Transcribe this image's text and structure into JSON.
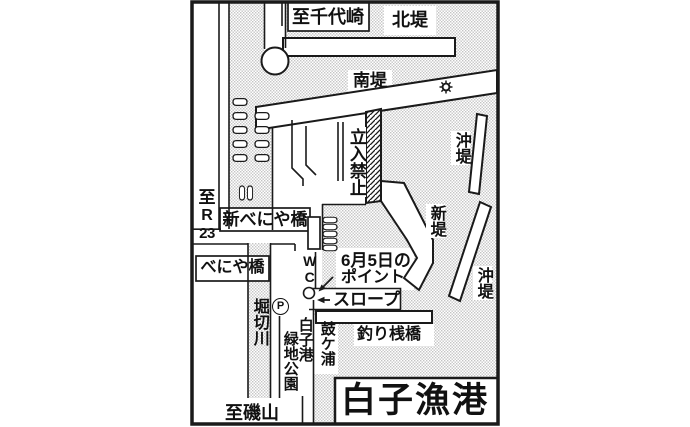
{
  "map": {
    "title": "白子漁港",
    "labels": {
      "to_chiyozaki": "至千代崎",
      "north_breakwater": "北堤",
      "south_breakwater": "南堤",
      "offshore_breakwater_upper": "沖堤",
      "offshore_breakwater_lower": "沖堤",
      "no_entry": "立入禁止",
      "new_breakwater": "新堤",
      "route_sign": {
        "chars": [
          "至",
          "R",
          "23"
        ]
      },
      "shin_beniya_bridge": "新べにや橋",
      "beniya_bridge": "べにや橋",
      "wc": "WC",
      "point_line1": "6月5日の",
      "point_line2": "ポイント",
      "slope": "スロープ",
      "parking": "P",
      "horikiri_river": "堀切川",
      "park_col_right": "白子港",
      "park_col_left": "緑地公園",
      "tsuzumigaura": "鼓ケ浦",
      "fishing_pier": "釣り桟橋",
      "to_isoyama": "至磯山"
    },
    "icons": {
      "harbor_light": "sun-gear-icon",
      "parking": "circled-p-icon",
      "point_marker": "small-circle-icon",
      "point_arrow": "arrow-down-left-icon",
      "slope_arrow": "arrow-left-icon",
      "boats": "moored-boat-icon",
      "wc_building": "toilet-building"
    },
    "colors": {
      "ink": "#1a1a1a",
      "paper": "#ffffff",
      "halftone": "#c4c4c4"
    }
  }
}
